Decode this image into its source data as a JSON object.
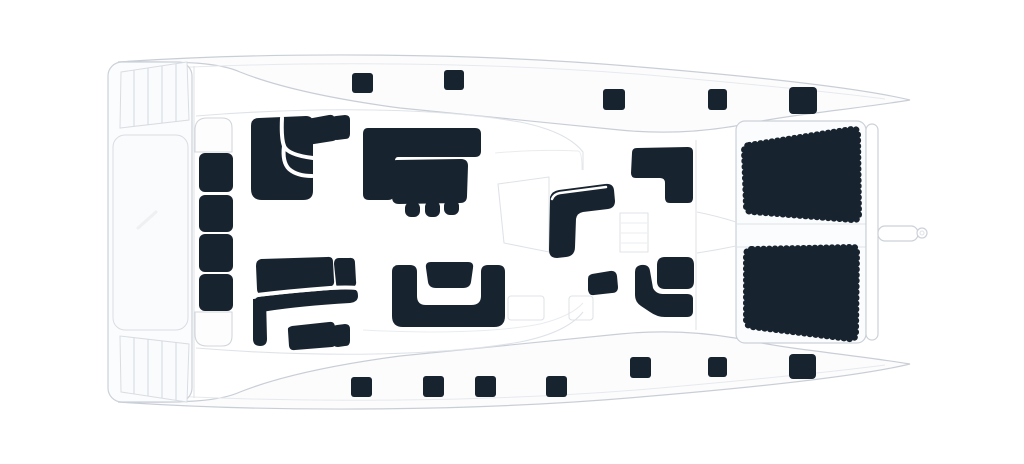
{
  "meta": {
    "type": "catamaran-deck-plan",
    "view": "top-down",
    "orientation": "bow-left-stern-right"
  },
  "colors": {
    "furniture": "#182330",
    "hull_line": "#c9ced6",
    "deck_line": "#dfe3e8",
    "panel_fill": "#fbfcfd",
    "background": "#ffffff"
  },
  "deck": {
    "hatches_top": [
      {
        "x": 352,
        "y": 73,
        "w": 21,
        "h": 20,
        "rx": 3
      },
      {
        "x": 444,
        "y": 70,
        "w": 20,
        "h": 20,
        "rx": 3
      },
      {
        "x": 603,
        "y": 89,
        "w": 22,
        "h": 21,
        "rx": 3
      },
      {
        "x": 708,
        "y": 89,
        "w": 19,
        "h": 21,
        "rx": 3
      },
      {
        "x": 789,
        "y": 87,
        "w": 28,
        "h": 27,
        "rx": 4
      }
    ],
    "hatches_bottom": [
      {
        "x": 351,
        "y": 377,
        "w": 21,
        "h": 20,
        "rx": 3
      },
      {
        "x": 423,
        "y": 376,
        "w": 21,
        "h": 21,
        "rx": 3
      },
      {
        "x": 475,
        "y": 376,
        "w": 21,
        "h": 21,
        "rx": 3
      },
      {
        "x": 546,
        "y": 376,
        "w": 21,
        "h": 21,
        "rx": 3
      },
      {
        "x": 630,
        "y": 357,
        "w": 21,
        "h": 21,
        "rx": 3
      },
      {
        "x": 708,
        "y": 357,
        "w": 19,
        "h": 20,
        "rx": 3
      },
      {
        "x": 789,
        "y": 354,
        "w": 27,
        "h": 25,
        "rx": 4
      }
    ],
    "bow_bench_segments": [
      {
        "x": 199,
        "y": 153,
        "w": 34,
        "h": 39,
        "rx": 6
      },
      {
        "x": 199,
        "y": 195,
        "w": 34,
        "h": 37,
        "rx": 6
      },
      {
        "x": 199,
        "y": 234,
        "w": 34,
        "h": 38,
        "rx": 6
      },
      {
        "x": 199,
        "y": 274,
        "w": 34,
        "h": 37,
        "rx": 6
      }
    ],
    "galley_stools": [
      {
        "x": 405,
        "y": 202,
        "w": 15,
        "h": 15,
        "rx": 6
      },
      {
        "x": 425,
        "y": 201,
        "w": 15,
        "h": 16,
        "rx": 6
      },
      {
        "x": 444,
        "y": 200,
        "w": 15,
        "h": 15,
        "rx": 6
      }
    ],
    "features": [
      "bow-trampolines",
      "foredeck-bench",
      "saloon-sofas",
      "galley-counter",
      "galley-table",
      "galley-stools",
      "helm-seat",
      "cockpit-benches",
      "cockpit-table-seats",
      "aft-sunpads",
      "transom-crossbar",
      "passerelle",
      "deck-hatches"
    ]
  }
}
